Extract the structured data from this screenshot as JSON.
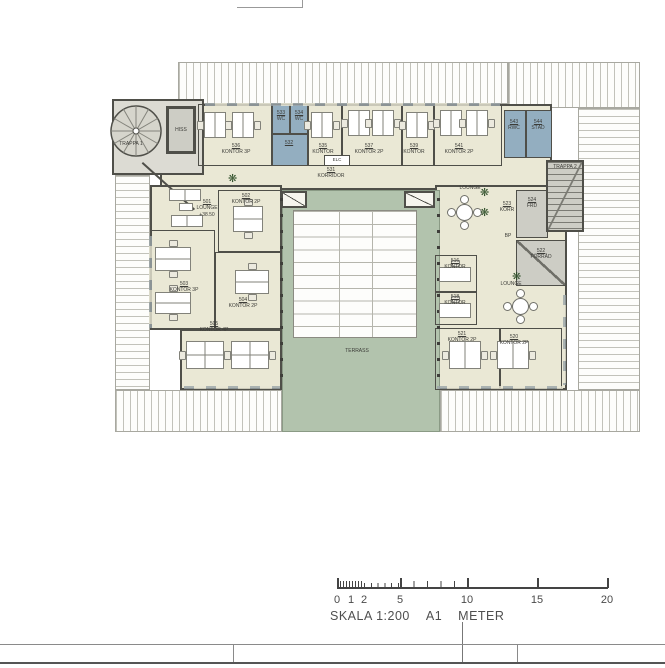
{
  "plan": {
    "rooms": {
      "trappa1": {
        "name": "TRAPPA 1"
      },
      "hiss": {
        "name": "HISS"
      },
      "k536": {
        "num": "536",
        "name": "KONTOR 3P"
      },
      "wc533": {
        "num": "533",
        "name": "WC"
      },
      "wc534": {
        "num": "534",
        "name": "WC"
      },
      "wc532": {
        "num": "532"
      },
      "k535": {
        "num": "535",
        "name": "KONTOR"
      },
      "k537": {
        "num": "537",
        "name": "KONTOR 2P"
      },
      "k539": {
        "num": "539",
        "name": "KONTOR"
      },
      "k541": {
        "num": "541",
        "name": "KONTOR 2P"
      },
      "rwc543": {
        "num": "543",
        "name": "RWC"
      },
      "stad544": {
        "num": "544",
        "name": "STÄD"
      },
      "trappa2": {
        "name": "TRAPPA 2"
      },
      "korridor": {
        "num": "531",
        "name": "KORRIDOR"
      },
      "elc": {
        "name": "ELC"
      },
      "lounge501": {
        "num": "501",
        "name": "LOUNGE",
        "level": "+38.50"
      },
      "k502": {
        "num": "502",
        "name": "KONTOR 2P"
      },
      "k503": {
        "num": "503",
        "name": "KONTOR 3P"
      },
      "k504": {
        "num": "504",
        "name": "KONTOR 2P"
      },
      "k505": {
        "num": "505",
        "name": "KONTOR 4P"
      },
      "lounge_ne": {
        "name": "LOUNGE"
      },
      "korr523": {
        "num": "523",
        "name": "KORR"
      },
      "frd524": {
        "num": "524",
        "name": "FRD"
      },
      "bp": {
        "name": "BP"
      },
      "forrad522": {
        "num": "522",
        "name": "FÖRRÅD"
      },
      "k516": {
        "num": "516",
        "name": "KONTOR"
      },
      "k518": {
        "num": "518",
        "name": "KONTOR"
      },
      "lounge_se": {
        "name": "LOUNGE"
      },
      "k521": {
        "num": "521",
        "name": "KONTOR 2P"
      },
      "k520": {
        "num": "520",
        "name": "KONTOR 2P"
      },
      "terrass": {
        "name": "TERRASS"
      }
    },
    "colors": {
      "room_fill": "#eae8d5",
      "wet_room_fill": "#93aec0",
      "terrace_fill": "#b2c3ad",
      "service_fill": "#cdcdc5"
    }
  },
  "scalebar": {
    "ticks": [
      "0",
      "1",
      "2",
      "5",
      "10",
      "15",
      "20"
    ],
    "caption": "SKALA 1:200",
    "sheet": "A1",
    "unit": "METER"
  }
}
